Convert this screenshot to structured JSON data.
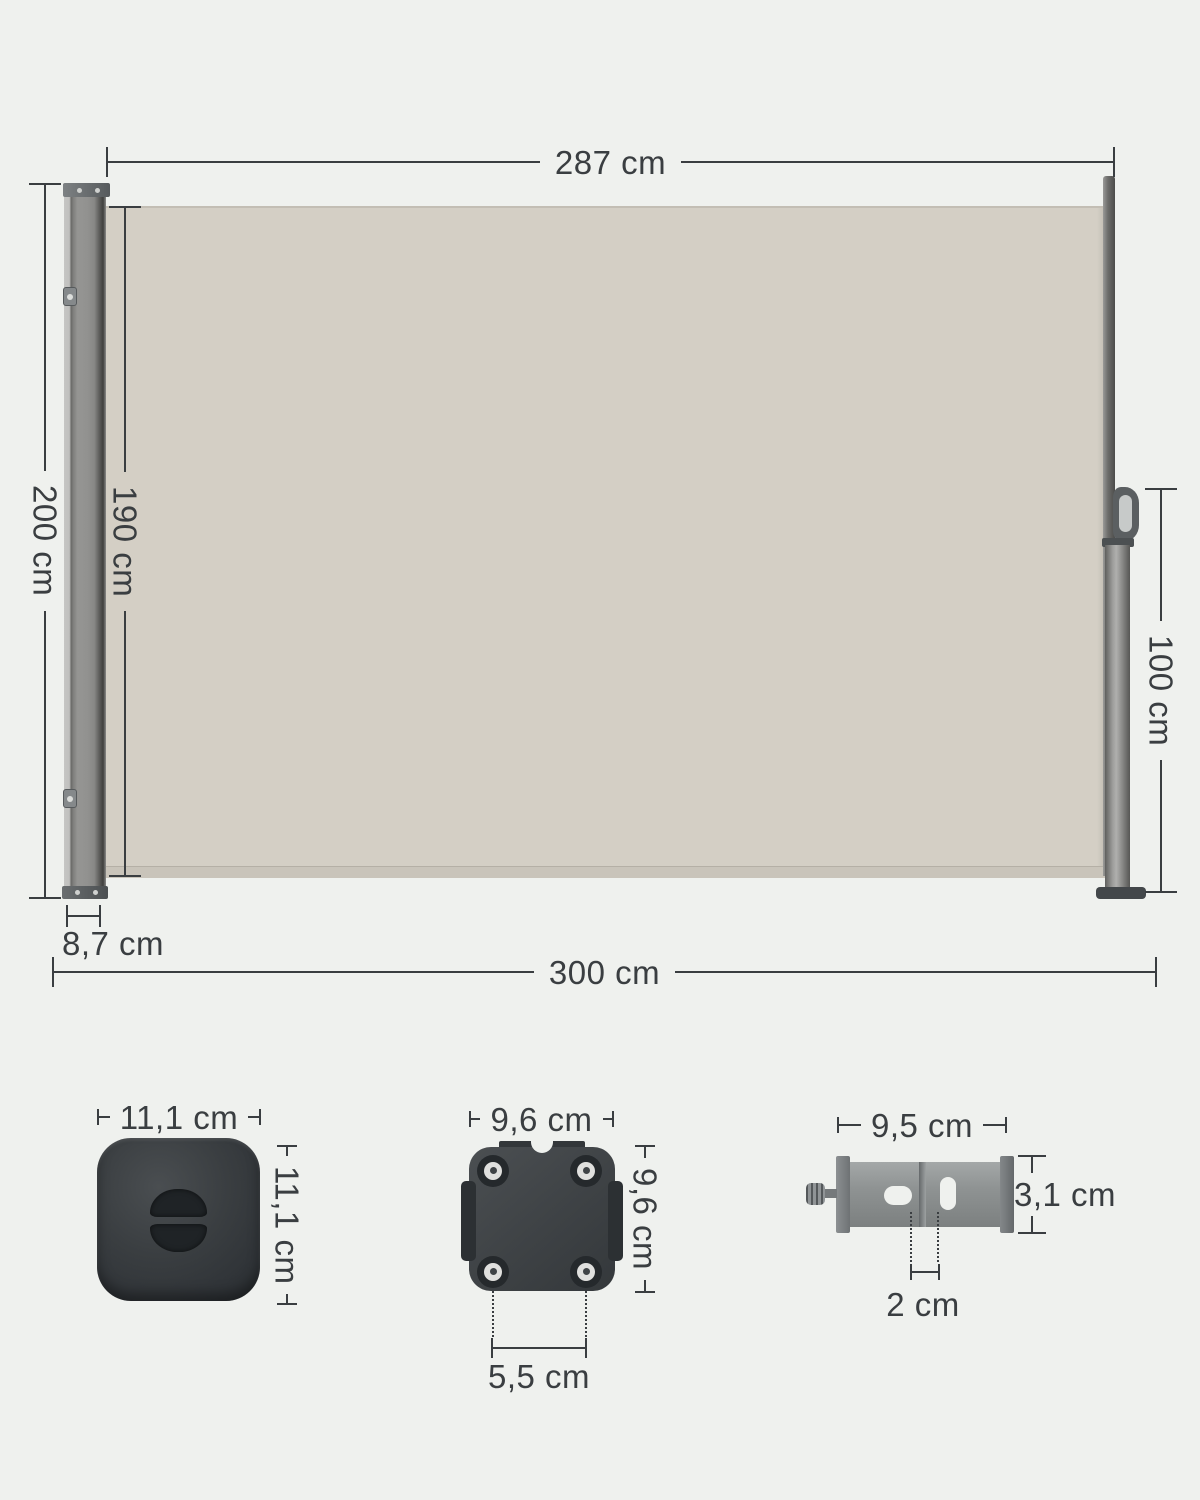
{
  "title": "Retractable side awning dimension diagram",
  "colors": {
    "background": "#eff1ee",
    "line": "#3a3e41",
    "fabric": "#d4cfc5",
    "fabric_hem": "#c9c4ba",
    "cassette_gray": "#929290",
    "hardware_dark": "#3b3f42",
    "bracket_gray": "#8f9393"
  },
  "awning": {
    "fabric_width": "287 cm",
    "total_height": "200 cm",
    "fabric_height": "190 cm",
    "pole_height": "100 cm",
    "cassette_depth": "8,7 cm",
    "total_width": "300 cm"
  },
  "floor_plate": {
    "width": "11,1 cm",
    "height": "11,1 cm"
  },
  "mounting_plate": {
    "width": "9,6 cm",
    "height": "9,6 cm",
    "hole_spacing": "5,5 cm"
  },
  "wall_bracket": {
    "width": "9,5 cm",
    "height": "3,1 cm",
    "slot_spacing": "2 cm"
  }
}
